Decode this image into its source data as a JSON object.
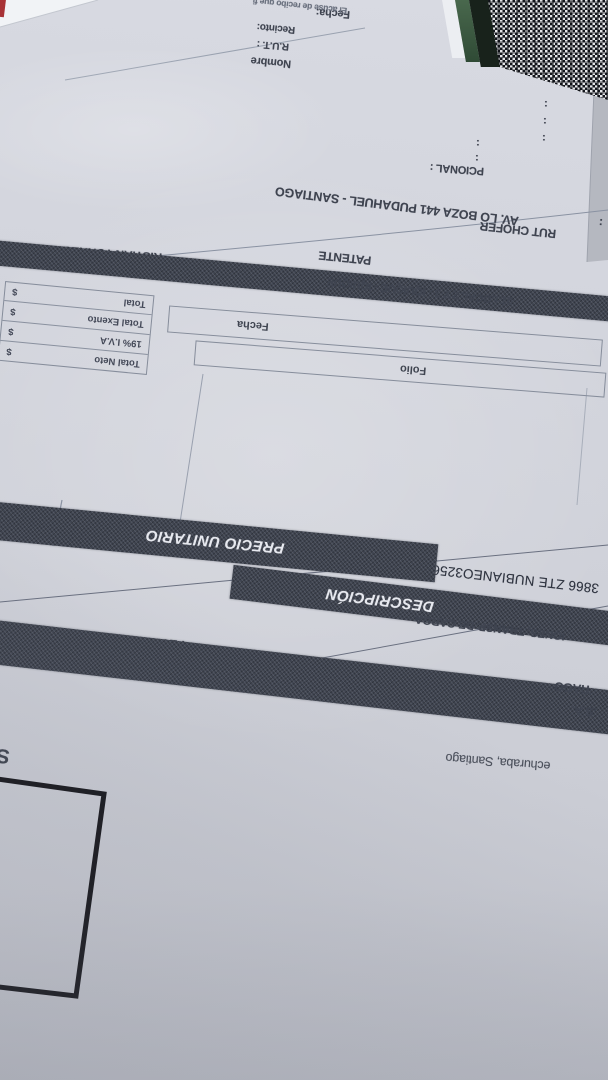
{
  "photo": {
    "description": "Upside-down photographed Chilean dispatch invoice (guia de despacho) on bluish paper",
    "top_fields": {
      "fecha": "Fecha:",
      "acuse": "El acuse de recibo que fi",
      "recinto": "Recinto:",
      "rut": "R.U.T. :",
      "nombre": "Nombre"
    },
    "colons": [
      ":",
      ":",
      ":",
      ":",
      ":"
    ],
    "mid_fields": {
      "pcional": "PCIONAL :",
      "address": "AV. LO BOZA 441 PUDAHUEL - SANTIAGO",
      "rut_chofer": "RUT CHOFER",
      "rut_chofer_colon": ":",
      "driver_name": "RISTIAN TORRES",
      "patente": "PATENTE",
      "sucursal": "01 LOCAL 2 Y 3 - IQUIQUE - IQUIQUE"
    },
    "totals_box": {
      "rows": [
        {
          "label": "Total Neto",
          "currency": "$"
        },
        {
          "label": "19% I.V.A",
          "currency": "$"
        },
        {
          "label": "Total Exento",
          "currency": "$"
        },
        {
          "label": "Total",
          "currency": "$"
        }
      ]
    },
    "folio_fecha": {
      "fecha": "Fecha",
      "folio": "Folio"
    },
    "items": {
      "quantity": "140",
      "description_line": "3866 ZTE NUBIANEO3256G NG POST-868197070872234"
    },
    "bands": {
      "precio_unitario": "PRECIO UNITARIO",
      "descripcion": "DESCRIPCIÓN"
    },
    "emitter": {
      "giro_fragment": "IONES, TRANSP. DE CARGA",
      "fecha_emision": "FECHA EMISION",
      "tipo_traslado": "TIPO TRASLAD",
      "city_fragment": "TIAGO",
      "company_fragment": ".S.A.",
      "address_fragment": "echuraba, Santiago",
      "left_fragment": "S"
    },
    "colors": {
      "paper": "#d3d5dd",
      "ink": "#3f4450",
      "band_dark": "#3f4450",
      "red_mark": "#a83236",
      "noise_green": "#3c5a40"
    }
  }
}
